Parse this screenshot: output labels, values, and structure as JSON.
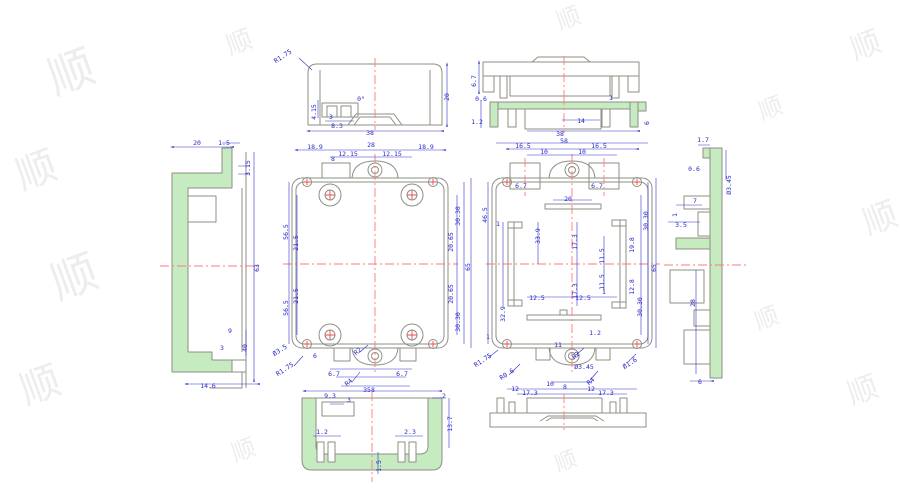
{
  "drawing": {
    "colors": {
      "dimension_blue": "#2828c8",
      "outline_gray": "#8f8f86",
      "section_green": "#c6ebc0",
      "centerline_red": "#ff7a7a",
      "background": "#ffffff",
      "watermark_gray": "#e7e7e7"
    },
    "watermark_char": "顺",
    "watermarks": [
      {
        "x": 55,
        "y": 95,
        "s": 46,
        "r": -20
      },
      {
        "x": 22,
        "y": 190,
        "s": 40,
        "r": -20
      },
      {
        "x": 58,
        "y": 300,
        "s": 46,
        "r": -20
      },
      {
        "x": 26,
        "y": 405,
        "s": 40,
        "r": -20
      },
      {
        "x": 230,
        "y": 55,
        "s": 26,
        "r": -20
      },
      {
        "x": 560,
        "y": 30,
        "s": 24,
        "r": -20
      },
      {
        "x": 855,
        "y": 60,
        "s": 30,
        "r": -20
      },
      {
        "x": 868,
        "y": 235,
        "s": 34,
        "r": -20
      },
      {
        "x": 852,
        "y": 405,
        "s": 30,
        "r": -20
      },
      {
        "x": 762,
        "y": 120,
        "s": 24,
        "r": -20
      },
      {
        "x": 758,
        "y": 330,
        "s": 24,
        "r": -20
      },
      {
        "x": 235,
        "y": 462,
        "s": 24,
        "r": -20
      },
      {
        "x": 558,
        "y": 472,
        "s": 22,
        "r": -20
      }
    ],
    "views": [
      {
        "id": "side-section-left",
        "label": "left side section view",
        "dims": [
          {
            "t": "20",
            "x": 197,
            "y": 145
          },
          {
            "t": "1.5",
            "x": 224,
            "y": 145
          },
          {
            "t": "3.15",
            "x": 250,
            "y": 168,
            "r": -90
          },
          {
            "t": "63",
            "x": 259,
            "y": 268,
            "r": -90
          },
          {
            "t": "9",
            "x": 230,
            "y": 333
          },
          {
            "t": "40",
            "x": 247,
            "y": 348,
            "r": -90
          },
          {
            "t": "3",
            "x": 222,
            "y": 350
          },
          {
            "t": "14.6",
            "x": 208,
            "y": 388
          }
        ]
      },
      {
        "id": "end-view-top",
        "label": "top end view",
        "dims": [
          {
            "t": "R1.75",
            "x": 284,
            "y": 58,
            "r": -33
          },
          {
            "t": "0°",
            "x": 361,
            "y": 101
          },
          {
            "t": "4.15",
            "x": 316,
            "y": 112,
            "r": -90
          },
          {
            "t": "3",
            "x": 331,
            "y": 119
          },
          {
            "t": "8.3",
            "x": 337,
            "y": 128
          },
          {
            "t": "20",
            "x": 449,
            "y": 97,
            "r": -90
          },
          {
            "t": "38",
            "x": 370,
            "y": 135
          }
        ]
      },
      {
        "id": "main-top-view",
        "label": "base outside top view",
        "dims": [
          {
            "t": "18.9",
            "x": 315,
            "y": 149
          },
          {
            "t": "12.15",
            "x": 348,
            "y": 156
          },
          {
            "t": "28",
            "x": 371,
            "y": 147
          },
          {
            "t": "12.15",
            "x": 392,
            "y": 156
          },
          {
            "t": "18.9",
            "x": 426,
            "y": 149
          },
          {
            "t": "8",
            "x": 333,
            "y": 161
          },
          {
            "t": "56.5",
            "x": 288,
            "y": 232,
            "r": -90
          },
          {
            "t": "21.5",
            "x": 298,
            "y": 243,
            "r": -90
          },
          {
            "t": "21.5",
            "x": 298,
            "y": 296,
            "r": -90
          },
          {
            "t": "56.5",
            "x": 288,
            "y": 308,
            "r": -90
          },
          {
            "t": "30.30",
            "x": 460,
            "y": 216,
            "r": -90
          },
          {
            "t": "20.65",
            "x": 453,
            "y": 242,
            "r": -90
          },
          {
            "t": "65",
            "x": 470,
            "y": 267,
            "r": -90
          },
          {
            "t": "20.65",
            "x": 453,
            "y": 294,
            "r": -90
          },
          {
            "t": "30.30",
            "x": 460,
            "y": 322,
            "r": -90
          },
          {
            "t": "6",
            "x": 315,
            "y": 358
          },
          {
            "t": "6.7",
            "x": 334,
            "y": 376
          },
          {
            "t": "6.7",
            "x": 402,
            "y": 376
          },
          {
            "t": "R2",
            "x": 359,
            "y": 353,
            "r": -40
          },
          {
            "t": "Ø3.5",
            "x": 281,
            "y": 352,
            "r": -33
          },
          {
            "t": "R1.75",
            "x": 286,
            "y": 371,
            "r": -33
          },
          {
            "t": "R4",
            "x": 350,
            "y": 384,
            "r": -40
          },
          {
            "t": "8",
            "x": 373,
            "y": 392
          }
        ]
      },
      {
        "id": "lid-side-views",
        "label": "lid side views",
        "dims": [
          {
            "t": "6.7",
            "x": 476,
            "y": 81,
            "r": -90
          },
          {
            "t": "0.6",
            "x": 481,
            "y": 101
          },
          {
            "t": "1.2",
            "x": 477,
            "y": 124
          },
          {
            "t": "1",
            "x": 611,
            "y": 100
          },
          {
            "t": "6",
            "x": 649,
            "y": 123,
            "r": -90
          },
          {
            "t": "14",
            "x": 581,
            "y": 123
          },
          {
            "t": "38",
            "x": 560,
            "y": 136
          }
        ]
      },
      {
        "id": "main-inside-view",
        "label": "base inside top view",
        "dims": [
          {
            "t": "16.5",
            "x": 523,
            "y": 148
          },
          {
            "t": "10",
            "x": 544,
            "y": 154
          },
          {
            "t": "58",
            "x": 564,
            "y": 143
          },
          {
            "t": "10",
            "x": 582,
            "y": 154
          },
          {
            "t": "16.5",
            "x": 599,
            "y": 148
          },
          {
            "t": "6.7",
            "x": 521,
            "y": 188
          },
          {
            "t": "6.7",
            "x": 597,
            "y": 188
          },
          {
            "t": "46.5",
            "x": 487,
            "y": 215,
            "r": -90
          },
          {
            "t": "1",
            "x": 498,
            "y": 226
          },
          {
            "t": "33.9",
            "x": 540,
            "y": 236,
            "r": -90
          },
          {
            "t": "17.3",
            "x": 577,
            "y": 242,
            "r": -90
          },
          {
            "t": "11.5",
            "x": 604,
            "y": 256,
            "r": -90
          },
          {
            "t": "20",
            "x": 568,
            "y": 201
          },
          {
            "t": "17.3",
            "x": 577,
            "y": 291,
            "r": -90
          },
          {
            "t": "11.5",
            "x": 604,
            "y": 282,
            "r": -90
          },
          {
            "t": "12.5",
            "x": 537,
            "y": 300
          },
          {
            "t": "12.5",
            "x": 583,
            "y": 300
          },
          {
            "t": "1",
            "x": 604,
            "y": 294
          },
          {
            "t": "32.9",
            "x": 505,
            "y": 314,
            "r": -90
          },
          {
            "t": "19.8",
            "x": 634,
            "y": 245,
            "r": -90
          },
          {
            "t": "12.8",
            "x": 634,
            "y": 287,
            "r": -90
          },
          {
            "t": "30.30",
            "x": 642,
            "y": 307,
            "r": -90
          },
          {
            "t": "30.30",
            "x": 648,
            "y": 221,
            "r": -90
          },
          {
            "t": "65",
            "x": 656,
            "y": 268,
            "r": -90
          },
          {
            "t": "1.2",
            "x": 595,
            "y": 335
          },
          {
            "t": "1",
            "x": 488,
            "y": 339
          },
          {
            "t": "11",
            "x": 558,
            "y": 347
          },
          {
            "t": "R1.75",
            "x": 484,
            "y": 362,
            "r": -33
          },
          {
            "t": "R0.6",
            "x": 508,
            "y": 376,
            "r": -33
          },
          {
            "t": "R2",
            "x": 577,
            "y": 357,
            "r": -40
          },
          {
            "t": "Ø3.45",
            "x": 584,
            "y": 369
          },
          {
            "t": "R4",
            "x": 592,
            "y": 383,
            "r": -40
          },
          {
            "t": "Ø1.6",
            "x": 631,
            "y": 365,
            "r": -33
          },
          {
            "t": "12",
            "x": 515,
            "y": 391
          },
          {
            "t": "17.3",
            "x": 530,
            "y": 395
          },
          {
            "t": "10",
            "x": 550,
            "y": 386
          },
          {
            "t": "8",
            "x": 565,
            "y": 389
          },
          {
            "t": "12",
            "x": 591,
            "y": 391
          },
          {
            "t": "17.3",
            "x": 606,
            "y": 395
          }
        ]
      },
      {
        "id": "side-section-right",
        "label": "right side section view",
        "dims": [
          {
            "t": "1.7",
            "x": 703,
            "y": 142
          },
          {
            "t": "0.6",
            "x": 694,
            "y": 171
          },
          {
            "t": "Ø3.45",
            "x": 731,
            "y": 185,
            "r": -90
          },
          {
            "t": "7",
            "x": 695,
            "y": 203
          },
          {
            "t": "1",
            "x": 677,
            "y": 215,
            "r": -90
          },
          {
            "t": "3.5",
            "x": 681,
            "y": 227
          },
          {
            "t": "28",
            "x": 695,
            "y": 303,
            "r": -90
          },
          {
            "t": "6",
            "x": 700,
            "y": 384
          }
        ]
      },
      {
        "id": "bottom-section-view",
        "label": "bottom section view",
        "dims": [
          {
            "t": "35",
            "x": 367,
            "y": 392
          },
          {
            "t": "9.3",
            "x": 330,
            "y": 398
          },
          {
            "t": "3",
            "x": 349,
            "y": 402
          },
          {
            "t": "2",
            "x": 444,
            "y": 398
          },
          {
            "t": "13.7",
            "x": 452,
            "y": 424,
            "r": -90
          },
          {
            "t": "1.2",
            "x": 322,
            "y": 434
          },
          {
            "t": "2.3",
            "x": 410,
            "y": 434
          },
          {
            "t": "1.5",
            "x": 381,
            "y": 466,
            "r": -90
          }
        ]
      },
      {
        "id": "lid-bottom-side-view",
        "label": "lid bottom side view",
        "dims": []
      }
    ]
  }
}
